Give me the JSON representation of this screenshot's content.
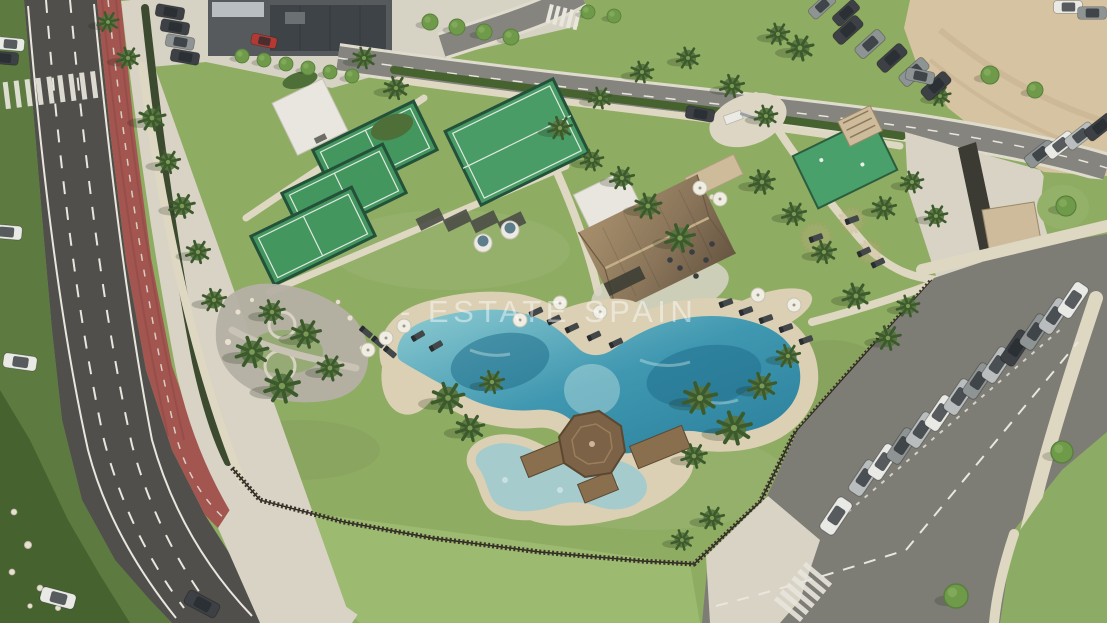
{
  "watermark": {
    "text": "- ESTATE SPAIN"
  },
  "palette": {
    "grass": "#8fac63",
    "grass_bright": "#9cba70",
    "grass_dark": "#5d7b40",
    "hedge": "#46622f",
    "road": "#504f4b",
    "road_light": "#7d7c75",
    "marking": "#e8e6dd",
    "bike_lane": "#a35550",
    "pavement": "#d8d3c5",
    "sand_path": "#ded7c2",
    "beach_sand": "#dbd0b4",
    "sand_lot": "#d6c3a2",
    "water_deep": "#2a7f9b",
    "water_light": "#9fd0d4",
    "kids_pool": "#a5cbcc",
    "court_green": "#44965f",
    "court_fence": "#23513a",
    "thatch": "#97805f",
    "wood": "#8a6f4f",
    "stone": "#cdbb9a",
    "fence": "#3a332c",
    "white_bldg": "#e9e6df",
    "gravel": "#b5b0a4",
    "palm": "#4e6d39",
    "tree": "#6f9a4a",
    "umbrella": "#f0ede3",
    "car_white": "#e9eae6",
    "car_silver": "#b9bdbd",
    "car_gray": "#8e9494",
    "car_dark": "#3d4145",
    "car_red": "#b33a32",
    "watermark": "#ffffff"
  },
  "scene": {
    "palms": [
      [
        152,
        118,
        1
      ],
      [
        168,
        162,
        0.9
      ],
      [
        182,
        206,
        0.95
      ],
      [
        198,
        252,
        0.9
      ],
      [
        214,
        300,
        0.9
      ],
      [
        252,
        352,
        1.2
      ],
      [
        282,
        386,
        1.3
      ],
      [
        306,
        334,
        1.1
      ],
      [
        330,
        368,
        1.0
      ],
      [
        272,
        312,
        0.95
      ],
      [
        448,
        398,
        1.2
      ],
      [
        470,
        428,
        1.05
      ],
      [
        492,
        382,
        0.9
      ],
      [
        700,
        398,
        1.25
      ],
      [
        734,
        428,
        1.3
      ],
      [
        762,
        386,
        1.05
      ],
      [
        694,
        456,
        0.95
      ],
      [
        788,
        356,
        0.9
      ],
      [
        648,
        206,
        1
      ],
      [
        622,
        178,
        0.9
      ],
      [
        680,
        238,
        1.1
      ],
      [
        592,
        160,
        0.85
      ],
      [
        560,
        128,
        0.9
      ],
      [
        600,
        98,
        0.85
      ],
      [
        642,
        72,
        0.85
      ],
      [
        688,
        58,
        0.85
      ],
      [
        732,
        86,
        0.9
      ],
      [
        766,
        116,
        0.85
      ],
      [
        800,
        48,
        1
      ],
      [
        778,
        34,
        0.85
      ],
      [
        762,
        182,
        0.95
      ],
      [
        794,
        214,
        0.9
      ],
      [
        824,
        252,
        0.9
      ],
      [
        884,
        208,
        0.9
      ],
      [
        912,
        182,
        0.85
      ],
      [
        936,
        216,
        0.85
      ],
      [
        856,
        296,
        1
      ],
      [
        888,
        338,
        0.95
      ],
      [
        908,
        306,
        0.85
      ],
      [
        712,
        518,
        0.9
      ],
      [
        682,
        540,
        0.8
      ],
      [
        128,
        58,
        0.85
      ],
      [
        108,
        22,
        0.8
      ],
      [
        396,
        88,
        0.9
      ],
      [
        364,
        58,
        0.85
      ],
      [
        940,
        96,
        0.8
      ]
    ],
    "trees": [
      [
        242,
        56,
        0.7
      ],
      [
        264,
        60,
        0.7
      ],
      [
        286,
        64,
        0.7
      ],
      [
        308,
        68,
        0.7
      ],
      [
        330,
        72,
        0.7
      ],
      [
        352,
        76,
        0.7
      ],
      [
        430,
        22,
        0.8
      ],
      [
        457,
        27,
        0.8
      ],
      [
        484,
        32,
        0.8
      ],
      [
        511,
        37,
        0.8
      ],
      [
        588,
        12,
        0.7
      ],
      [
        614,
        16,
        0.7
      ],
      [
        1066,
        206,
        1.0
      ],
      [
        990,
        75,
        0.9
      ],
      [
        1035,
        90,
        0.8
      ],
      [
        956,
        596,
        1.2
      ],
      [
        1062,
        452,
        1.1
      ]
    ],
    "loungers": [
      [
        536,
        312,
        -25
      ],
      [
        554,
        320,
        -25
      ],
      [
        572,
        328,
        -25
      ],
      [
        594,
        336,
        -25
      ],
      [
        616,
        343,
        -25
      ],
      [
        418,
        336,
        -30
      ],
      [
        436,
        346,
        -30
      ],
      [
        390,
        352,
        40
      ],
      [
        378,
        342,
        40
      ],
      [
        366,
        332,
        40
      ],
      [
        726,
        303,
        -20
      ],
      [
        746,
        311,
        -20
      ],
      [
        766,
        319,
        -20
      ],
      [
        786,
        328,
        -20
      ],
      [
        806,
        340,
        -20
      ],
      [
        864,
        252,
        -25
      ],
      [
        878,
        263,
        -25
      ],
      [
        816,
        238,
        -20
      ],
      [
        852,
        220,
        -20
      ]
    ],
    "umbrellas": [
      [
        560,
        303
      ],
      [
        600,
        312
      ],
      [
        520,
        320
      ],
      [
        758,
        295
      ],
      [
        794,
        305
      ],
      [
        404,
        326
      ],
      [
        386,
        338
      ],
      [
        368,
        350
      ],
      [
        700,
        188
      ],
      [
        720,
        199
      ]
    ],
    "rocks": [
      [
        238,
        312,
        1
      ],
      [
        228,
        342,
        1.2
      ],
      [
        252,
        300,
        0.8
      ],
      [
        350,
        318,
        1
      ],
      [
        362,
        348,
        0.9
      ],
      [
        338,
        302,
        0.8
      ],
      [
        14,
        512,
        1
      ],
      [
        28,
        545,
        1.2
      ],
      [
        12,
        572,
        1
      ],
      [
        40,
        588,
        1
      ],
      [
        58,
        608,
        0.9
      ],
      [
        30,
        606,
        0.8
      ],
      [
        700,
        192,
        1.1
      ],
      [
        712,
        197,
        0.9
      ]
    ],
    "cars": [
      [
        6,
        232,
        5,
        "car_white",
        1
      ],
      [
        20,
        362,
        8,
        "car_white",
        1.05
      ],
      [
        58,
        598,
        15,
        "car_white",
        1.1
      ],
      [
        202,
        604,
        28,
        "car_dark",
        1.1
      ],
      [
        10,
        44,
        5,
        "car_white",
        0.9
      ],
      [
        4,
        58,
        5,
        "car_dark",
        0.9
      ],
      [
        170,
        12,
        10,
        "car_dark",
        0.9
      ],
      [
        175,
        27,
        10,
        "car_dark",
        0.9
      ],
      [
        180,
        42,
        10,
        "car_gray",
        0.9
      ],
      [
        185,
        57,
        10,
        "car_dark",
        0.9
      ],
      [
        264,
        41,
        12,
        "car_red",
        0.8
      ],
      [
        848,
        30,
        -42,
        "car_dark",
        1
      ],
      [
        870,
        44,
        -42,
        "car_gray",
        1
      ],
      [
        892,
        58,
        -42,
        "car_dark",
        1
      ],
      [
        914,
        72,
        -42,
        "car_gray",
        1
      ],
      [
        936,
        86,
        -42,
        "car_dark",
        1
      ],
      [
        700,
        114,
        10,
        "car_dark",
        0.9
      ],
      [
        920,
        76,
        12,
        "car_gray",
        0.9
      ],
      [
        822,
        6,
        -42,
        "car_gray",
        0.9
      ],
      [
        846,
        13,
        -42,
        "car_dark",
        0.9
      ],
      [
        1068,
        7,
        0,
        "car_white",
        0.9
      ],
      [
        1092,
        13,
        0,
        "car_gray",
        0.9
      ],
      [
        1040,
        154,
        -38,
        "car_gray",
        1
      ],
      [
        1060,
        145,
        -38,
        "car_white",
        1
      ],
      [
        1080,
        136,
        -38,
        "car_silver",
        1
      ],
      [
        1100,
        127,
        -38,
        "car_dark",
        1
      ],
      [
        864,
        478,
        -56,
        "car_silver",
        1.15
      ],
      [
        883,
        462,
        -56,
        "car_white",
        1.15
      ],
      [
        902,
        446,
        -56,
        "car_gray",
        1.15
      ],
      [
        921,
        430,
        -56,
        "car_silver",
        1.15
      ],
      [
        940,
        413,
        -56,
        "car_white",
        1.15
      ],
      [
        959,
        397,
        -56,
        "car_silver",
        1.15
      ],
      [
        978,
        381,
        -56,
        "car_gray",
        1.15
      ],
      [
        997,
        365,
        -56,
        "car_silver",
        1.15
      ],
      [
        1016,
        348,
        -56,
        "car_dark",
        1.15
      ],
      [
        1035,
        332,
        -56,
        "car_gray",
        1.15
      ],
      [
        1054,
        316,
        -56,
        "car_silver",
        1.15
      ],
      [
        1073,
        300,
        -56,
        "car_white",
        1.15
      ],
      [
        836,
        516,
        -56,
        "car_white",
        1.2
      ]
    ]
  }
}
